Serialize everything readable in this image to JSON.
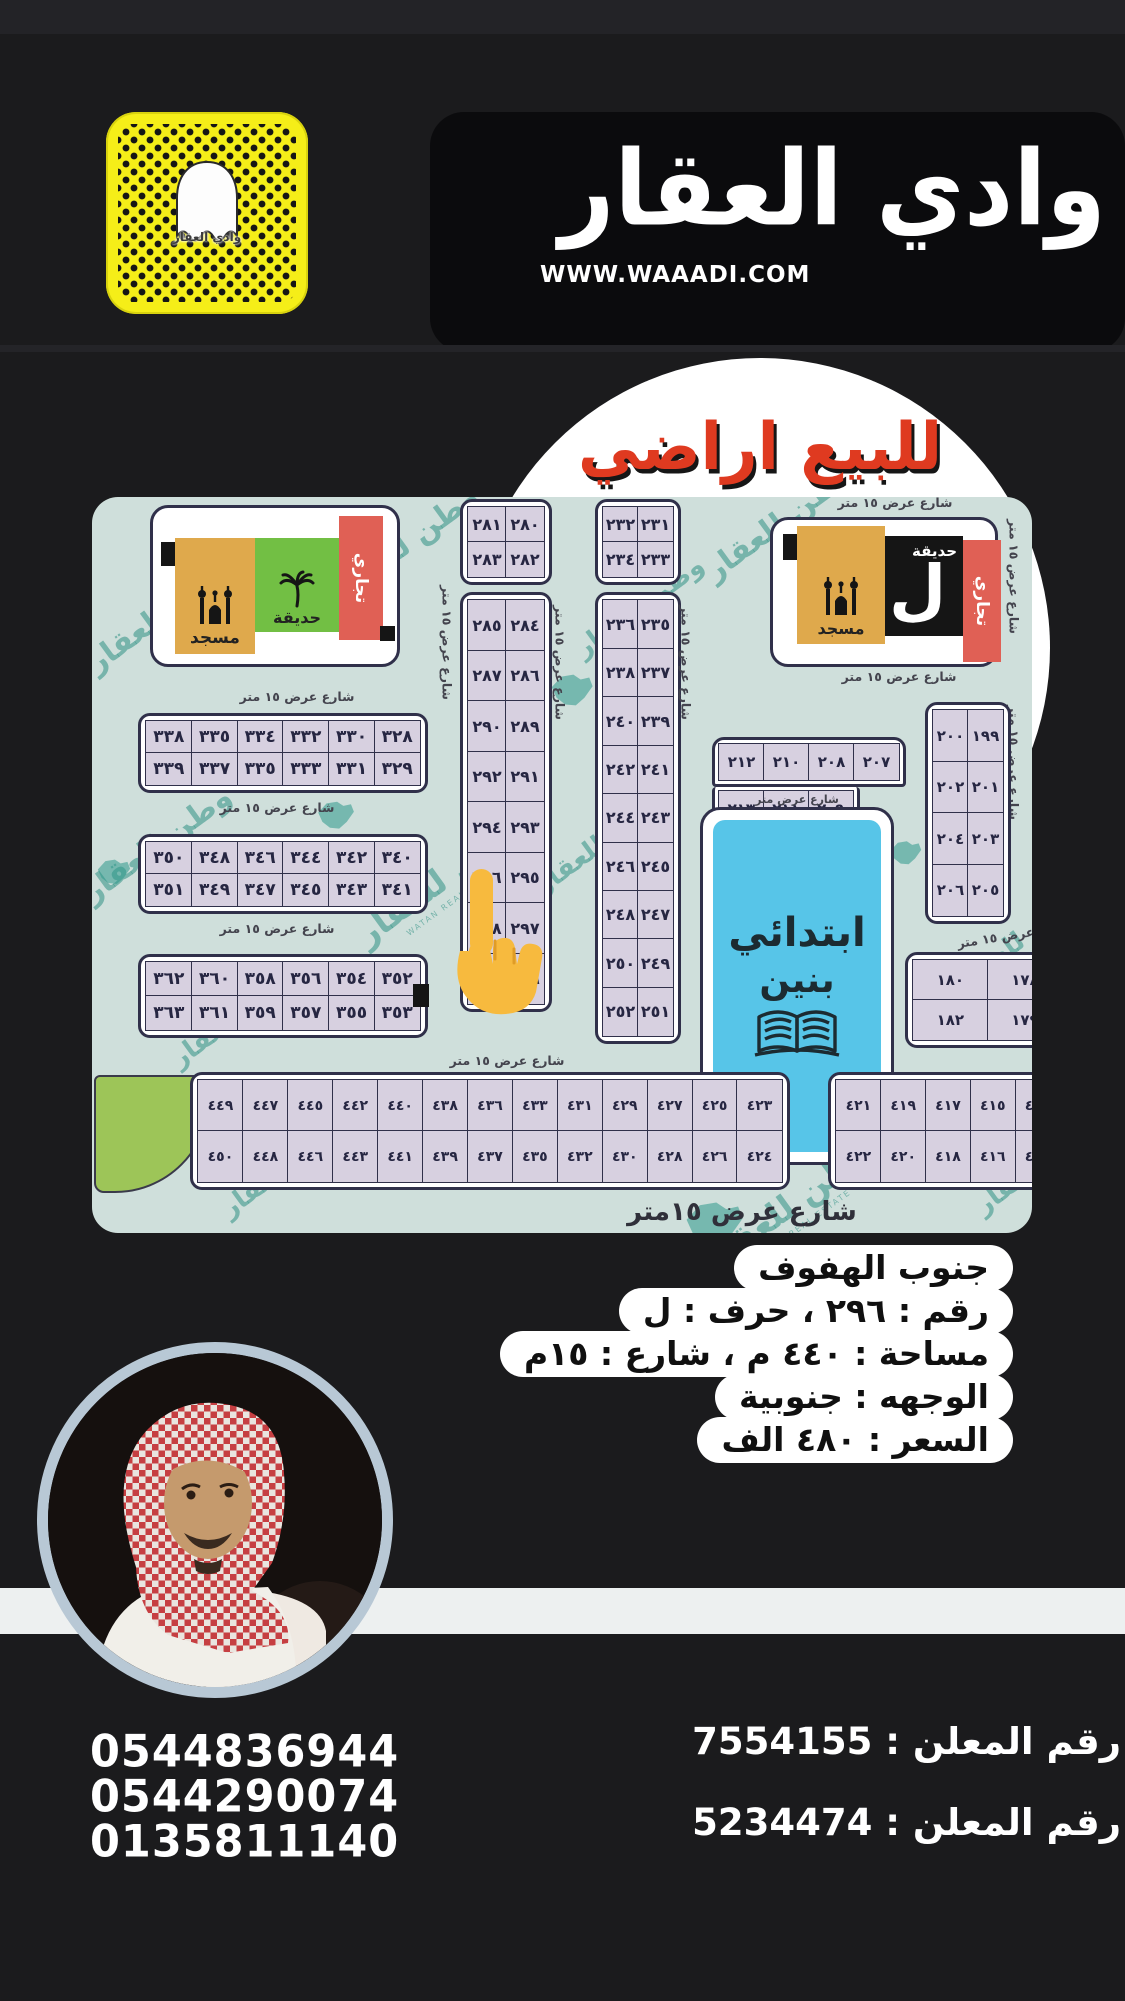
{
  "page": {
    "bg": "#1b1b1d"
  },
  "header": {
    "brand": "وادي العقار",
    "website": "WWW.WAAADI.COM",
    "snapcode_label": "وادي العقار"
  },
  "banner": {
    "title": "للبيع اراضي",
    "title_color": "#df3a20"
  },
  "map": {
    "street_label": "شارع عرض ١٥ متر",
    "street_label_partial": "شارع عرض  متر",
    "street_label_big": "شارع عرض ١٥متر",
    "watermark": "وطن للعقار",
    "watermark_sub": "WATAN REAL ESTATE",
    "facilities": {
      "mosque": "مسجد",
      "garden": "حديقة",
      "commercial": "تجاري",
      "letter": "ل"
    },
    "school": {
      "line1": "ابتدائي",
      "line2": "بنين"
    },
    "blocks": {
      "colA1": [
        [
          "٢٨١",
          "٢٨٠"
        ],
        [
          "٢٨٣",
          "٢٨٢"
        ]
      ],
      "colA2": [
        [
          "٢٨٥",
          "٢٨٤"
        ],
        [
          "٢٨٧",
          "٢٨٦"
        ],
        [
          "٢٩٠",
          "٢٨٩"
        ],
        [
          "٢٩٢",
          "٢٩١"
        ],
        [
          "٢٩٤",
          "٢٩٣"
        ],
        [
          "٢٩٦",
          "٢٩٥"
        ],
        [
          "٢٩٨",
          "٢٩٧"
        ],
        [
          "٣٠٠",
          "٢٩٩"
        ]
      ],
      "colB1": [
        [
          "٢٣٢",
          "٢٣١"
        ],
        [
          "٢٣٤",
          "٢٣٣"
        ]
      ],
      "colB2": [
        [
          "٢٣٦",
          "٢٣٥"
        ],
        [
          "٢٣٨",
          "٢٣٧"
        ],
        [
          "٢٤٠",
          "٢٣٩"
        ],
        [
          "٢٤٢",
          "٢٤١"
        ],
        [
          "٢٤٤",
          "٢٤٣"
        ],
        [
          "٢٤٦",
          "٢٤٥"
        ],
        [
          "٢٤٨",
          "٢٤٧"
        ],
        [
          "٢٥٠",
          "٢٤٩"
        ],
        [
          "٢٥٢",
          "٢٥١"
        ]
      ],
      "left1": [
        [
          "٣٣٨",
          "٣٣٥",
          "٣٣٤",
          "٣٣٢",
          "٣٣٠",
          "٣٢٨"
        ],
        [
          "٣٣٩",
          "٣٣٧",
          "٣٣٥",
          "٣٣٣",
          "٣٣١",
          "٣٢٩"
        ]
      ],
      "left2": [
        [
          "٣٥٠",
          "٣٤٨",
          "٣٤٦",
          "٣٤٤",
          "٣٤٢",
          "٣٤٠"
        ],
        [
          "٣٥١",
          "٣٤٩",
          "٣٤٧",
          "٣٤٥",
          "٣٤٣",
          "٣٤١"
        ]
      ],
      "left3": [
        [
          "٣٦٢",
          "٣٦٠",
          "٣٥٨",
          "٣٥٦",
          "٣٥٤",
          "٣٥٢"
        ],
        [
          "٣٦٣",
          "٣٦١",
          "٣٥٩",
          "٣٥٧",
          "٣٥٥",
          "٣٥٣"
        ]
      ],
      "lshape_top": [
        [
          "٢١٢",
          "٢١٠",
          "٢٠٨",
          "٢٠٧"
        ]
      ],
      "lshape_bottom": [
        [
          "٢١٣",
          "٢١١",
          "٢٠٩"
        ]
      ],
      "col199": [
        [
          "٢٠٠",
          "١٩٩"
        ],
        [
          "٢٠٢",
          "٢٠١"
        ],
        [
          "٢٠٤",
          "٢٠٣"
        ],
        [
          "٢٠٦",
          "٢٠٥"
        ]
      ],
      "block178": [
        [
          "١٨٠",
          "١٧٨",
          ""
        ],
        [
          "١٨٢",
          "١٧٩",
          ""
        ]
      ],
      "stripL": [
        [
          "٤٤٩",
          "٤٤٧",
          "٤٤٥",
          "٤٤٢",
          "٤٤٠",
          "٤٣٨",
          "٤٣٦",
          "٤٣٣",
          "٤٣١",
          "٤٢٩",
          "٤٢٧",
          "٤٢٥",
          "٤٢٣"
        ],
        [
          "٤٥٠",
          "٤٤٨",
          "٤٤٦",
          "٤٤٣",
          "٤٤١",
          "٤٣٩",
          "٤٣٧",
          "٤٣٥",
          "٤٣٢",
          "٤٣٠",
          "٤٢٨",
          "٤٢٦",
          "٤٢٤"
        ]
      ],
      "stripR": [
        [
          "٤٢١",
          "٤١٩",
          "٤١٧",
          "٤١٥",
          "٤١٣"
        ],
        [
          "٤٢٢",
          "٤٢٠",
          "٤١٨",
          "٤١٦",
          "٤١٤"
        ]
      ]
    }
  },
  "details": {
    "lines": [
      "جنوب الهفوف",
      "رقم : ٢٩٦ ، حرف : ل",
      "مساحة : ٤٤٠ م ، شارع : ١٥م",
      "الوجهه : جنوبية",
      "السعر : ٤٨٠ الف"
    ]
  },
  "contact": {
    "phones": [
      "0544836944",
      "0544290074",
      "0135811140"
    ],
    "advertiser_ids": [
      "رقم المعلن : 7554155",
      "رقم المعلن : 5234474"
    ]
  }
}
